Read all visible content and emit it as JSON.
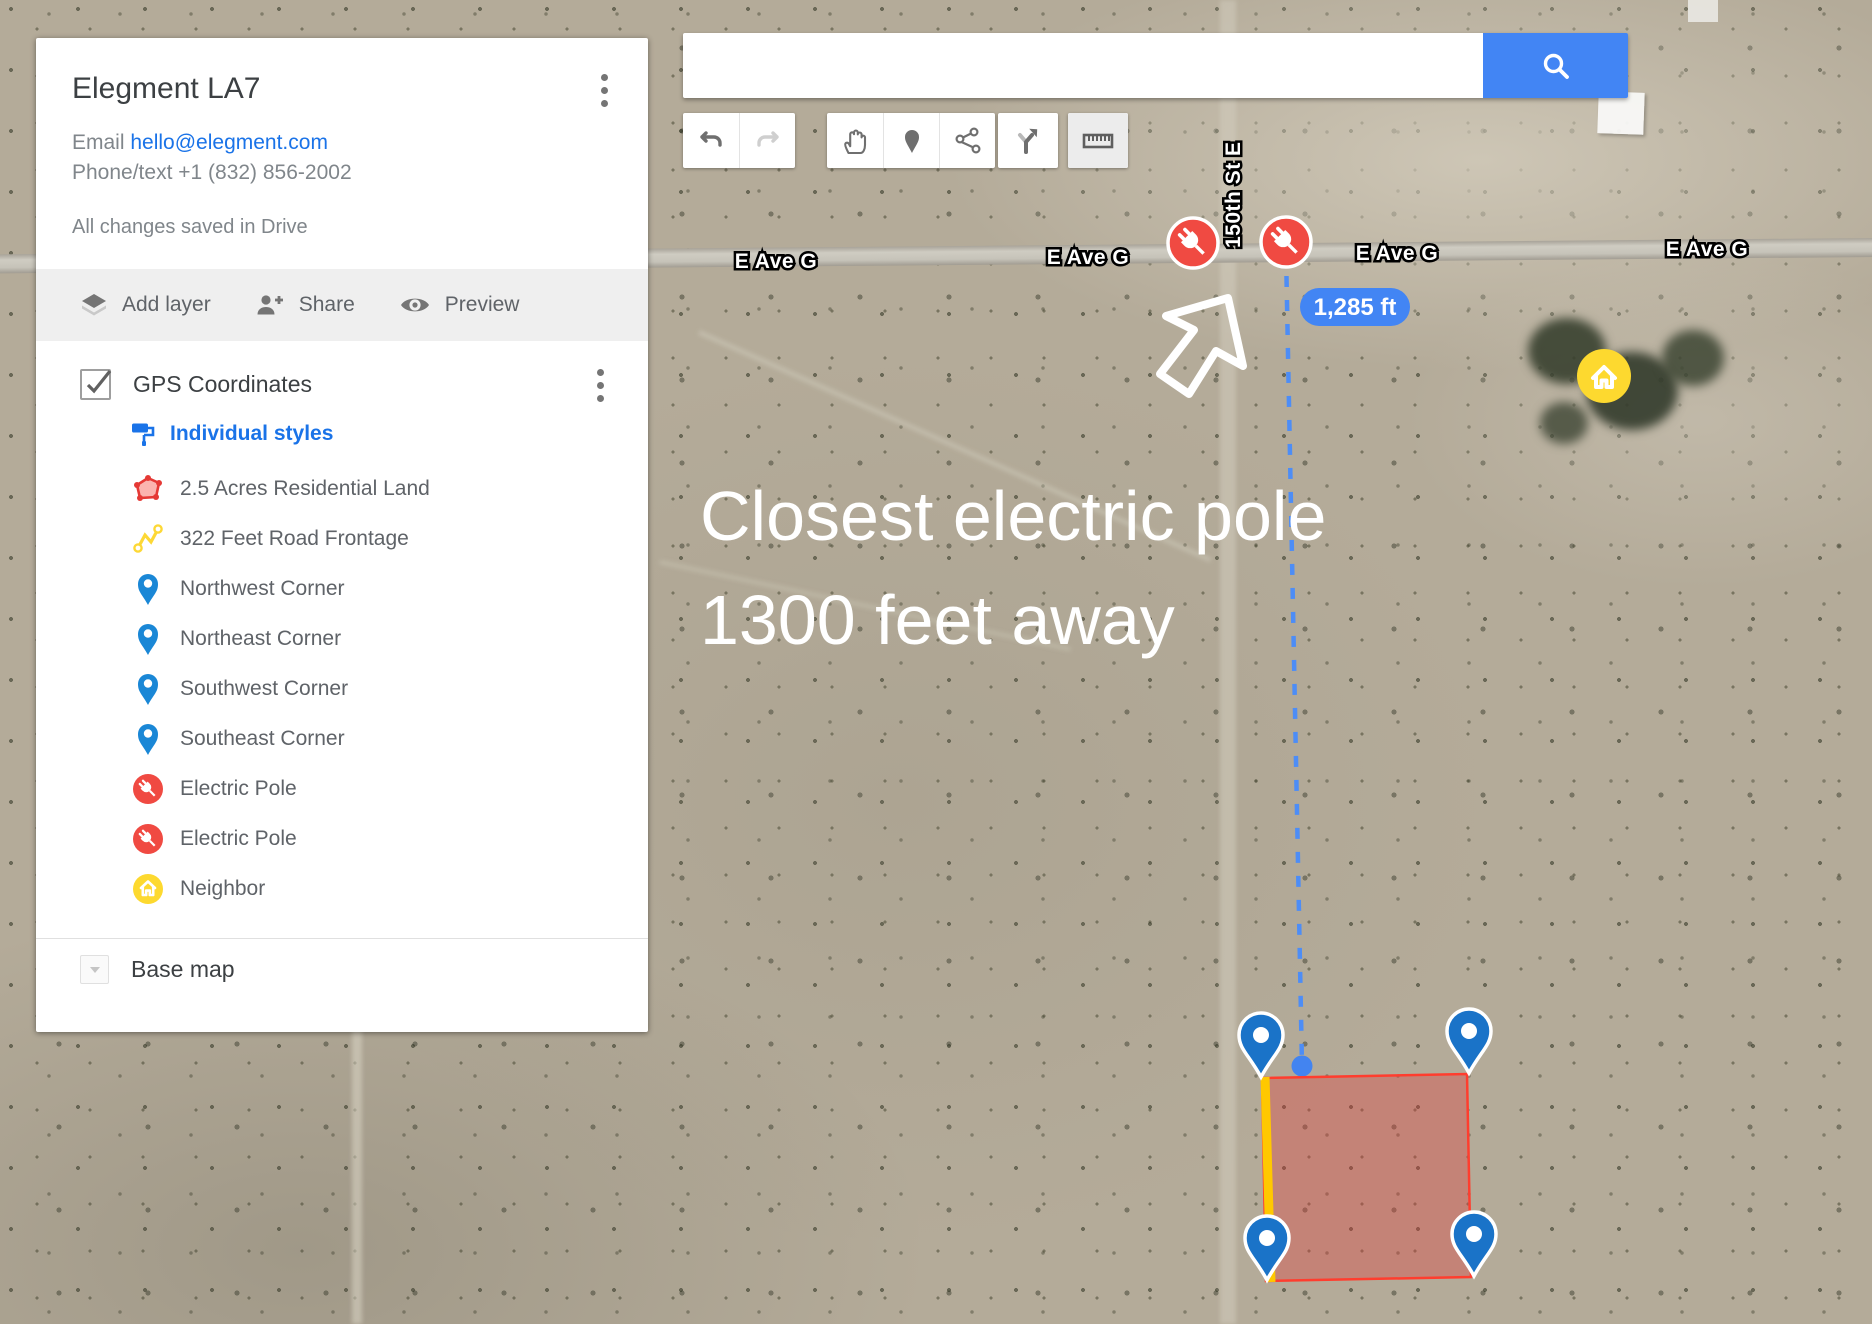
{
  "panel": {
    "title": "Elegment LA7",
    "email_label": "Email ",
    "email_link": "hello@elegment.com",
    "phone": "Phone/text +1 (832) 856-2002",
    "saved_status": "All changes saved in Drive",
    "actions": {
      "add_layer": "Add layer",
      "share": "Share",
      "preview": "Preview"
    },
    "layer": {
      "name": "GPS Coordinates",
      "checked": true,
      "styles_link": "Individual styles",
      "items": [
        {
          "label": "2.5 Acres Residential Land",
          "icon": "red-polygon-icon"
        },
        {
          "label": "322 Feet Road Frontage",
          "icon": "yellow-polyline-icon"
        },
        {
          "label": "Northwest Corner",
          "icon": "blue-pin-icon"
        },
        {
          "label": "Northeast Corner",
          "icon": "blue-pin-icon"
        },
        {
          "label": "Southwest Corner",
          "icon": "blue-pin-icon"
        },
        {
          "label": "Southeast Corner",
          "icon": "blue-pin-icon"
        },
        {
          "label": "Electric Pole",
          "icon": "electric-pole-icon"
        },
        {
          "label": "Electric Pole",
          "icon": "electric-pole-icon"
        },
        {
          "label": "Neighbor",
          "icon": "home-icon"
        }
      ]
    },
    "base_map_label": "Base map"
  },
  "search": {
    "value": "",
    "placeholder": ""
  },
  "map": {
    "road_labels": [
      "E Ave G",
      "E Ave G",
      "E Ave G",
      "E Ave G"
    ],
    "street_label": "150th St E",
    "measurement_badge": "1,285 ft",
    "annotation_line1": "Closest electric pole",
    "annotation_line2": "1300 feet away"
  },
  "colors": {
    "link_blue": "#1a73e8",
    "search_button_blue": "#4285f4",
    "measure_badge_blue": "#4285f4",
    "electric_pole_red": "#f04a42",
    "neighbor_yellow": "#fdd92f",
    "corner_pin_blue": "#1a73c8",
    "polygon_red": "#ff3d2e",
    "road_frontage_yellow": "#ffc800"
  }
}
